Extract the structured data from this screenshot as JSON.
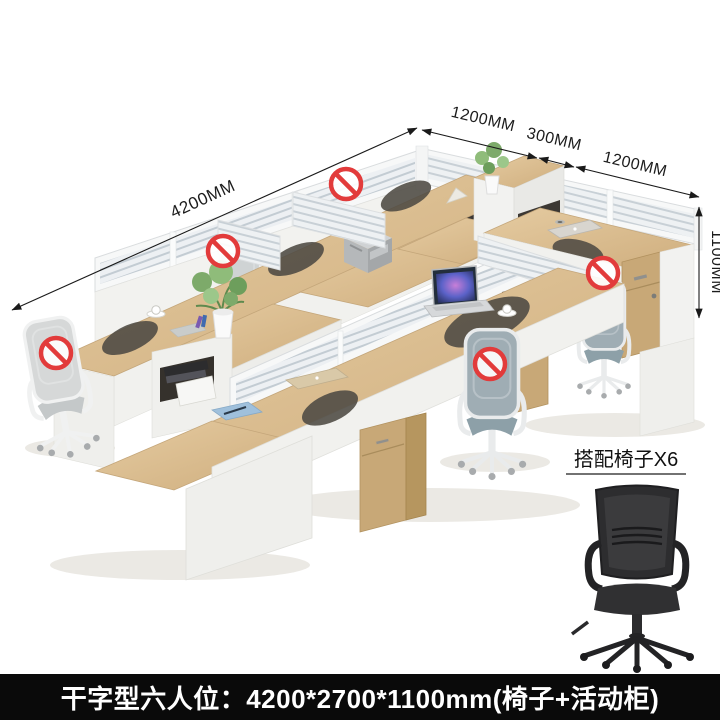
{
  "product_image": {
    "type": "office-workstation-product-photo",
    "dimension_labels": {
      "length_total": "4200MM",
      "depth_seg_a": "1200MM",
      "depth_seg_b": "300MM",
      "depth_seg_c": "1200MM",
      "height": "1100MM"
    },
    "prohibition_watermark_count": 5,
    "inset": {
      "caption": "搭配椅子X6"
    },
    "banner": {
      "caption": "干字型六人位：4200*2700*1100mm(椅子+活动柜)"
    },
    "colors": {
      "wood": "#d9bb8e",
      "wood_dark": "#c2a378",
      "panel_white": "#f2f2f0",
      "slat_line": "#c3ccd3",
      "mesh_gray": "#9fadb4",
      "prohibition_red": "#e23b3b",
      "banner_bg": "#0a0a0a",
      "banner_text": "#ffffff"
    }
  }
}
